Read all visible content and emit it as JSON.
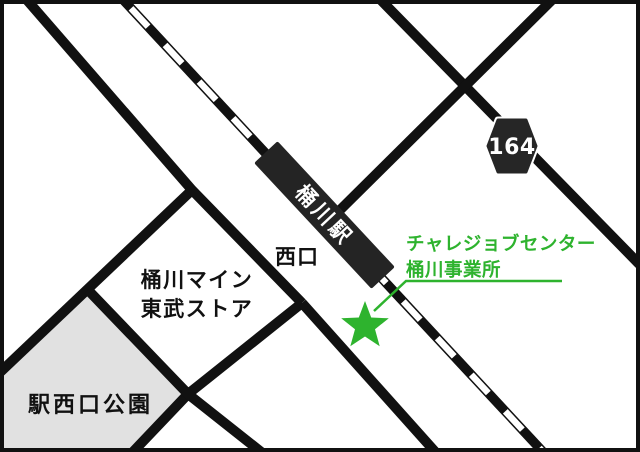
{
  "map_title": "桶川駅周辺アクセスマップ",
  "colors": {
    "ink": "#111111",
    "white": "#ffffff",
    "green": "#2eb32e",
    "park_fill": "#e1e1e1",
    "badge_fill": "#262626",
    "station_fill": "#242424"
  },
  "station": {
    "name": "桶川駅"
  },
  "route_badge": {
    "number": "164"
  },
  "labels": {
    "west_exit": "西口",
    "store_line1": "桶川マイン",
    "store_line2": "東武ストア",
    "park": "駅西口公園"
  },
  "destination": {
    "line1": "チャレジョブセンター",
    "line2": "桶川事業所"
  }
}
